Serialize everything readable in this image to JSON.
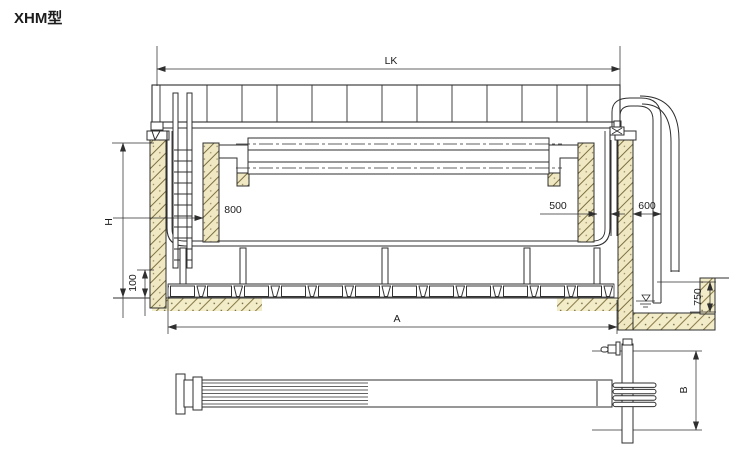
{
  "title": "XHM型",
  "labels": {
    "lk": "LK",
    "h": "H",
    "d800": "800",
    "d500": "500",
    "d600": "600",
    "d100": "100",
    "a": "A",
    "d750": "750",
    "b": "B"
  },
  "colors": {
    "line": "#2f2f2f",
    "concrete_fill": "#efe8c2",
    "ground_fill": "#f2ecc8",
    "background": "#ffffff"
  }
}
